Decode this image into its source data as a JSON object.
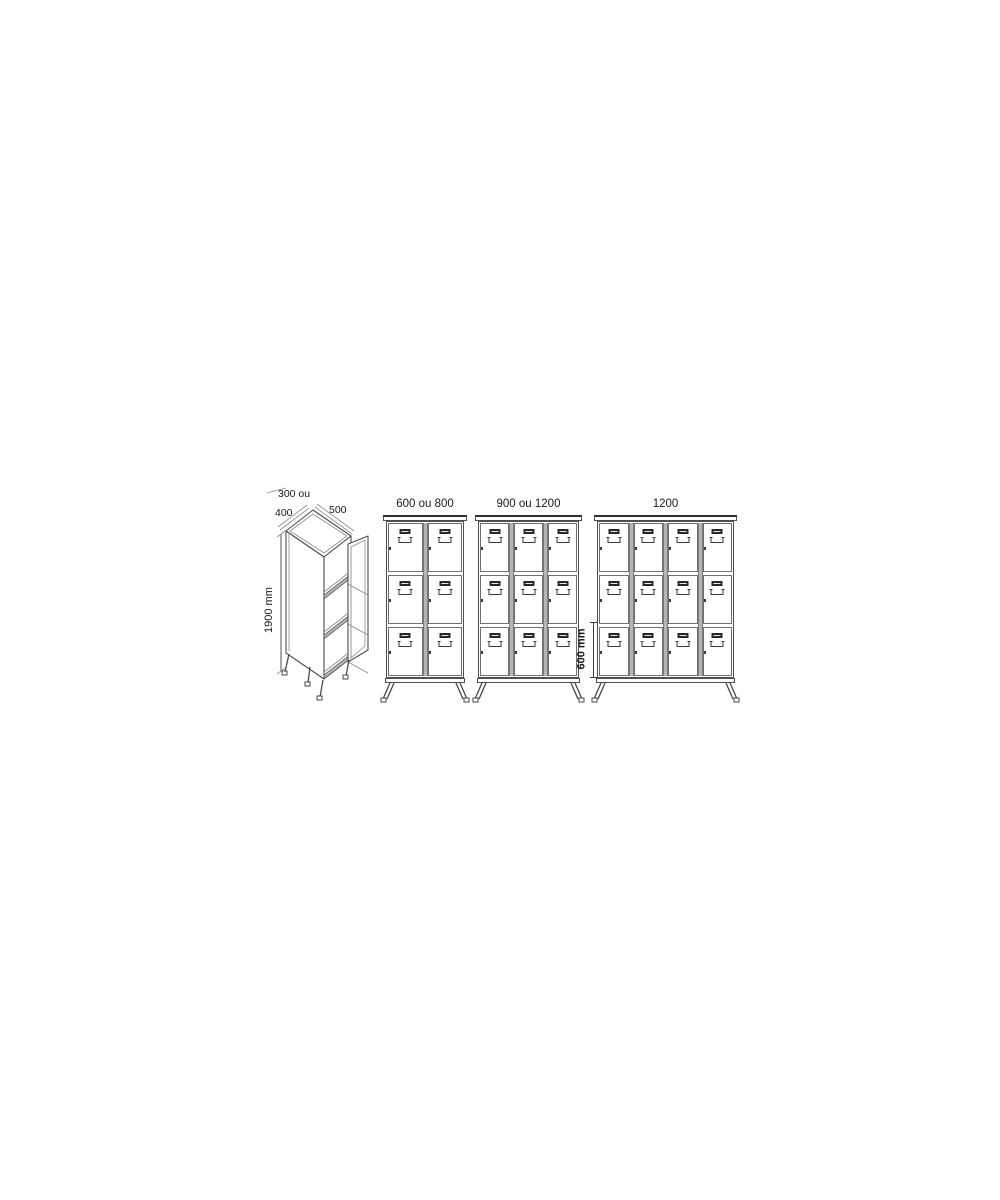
{
  "background": "#ffffff",
  "isometric": {
    "width_option_line1": "300 ou",
    "width_option_line2": "400",
    "depth_label": "500",
    "height_label": "1900 mm",
    "shelf_count": 3
  },
  "lockers": [
    {
      "label": "600 ou 800",
      "columns": 2,
      "rows": 3
    },
    {
      "label": "900 ou 1200",
      "columns": 3,
      "rows": 3
    },
    {
      "label": "1200",
      "columns": 4,
      "rows": 3
    }
  ],
  "compartment_dim": {
    "label": "600 mm"
  },
  "colors": {
    "line": "#4f4f4f",
    "light_line": "#8a8a8a",
    "divider_fill": "#b5b5b5",
    "shelf_fill": "#b0b0b0",
    "label_holder": "#26262e",
    "text": "#1a1a1a"
  }
}
